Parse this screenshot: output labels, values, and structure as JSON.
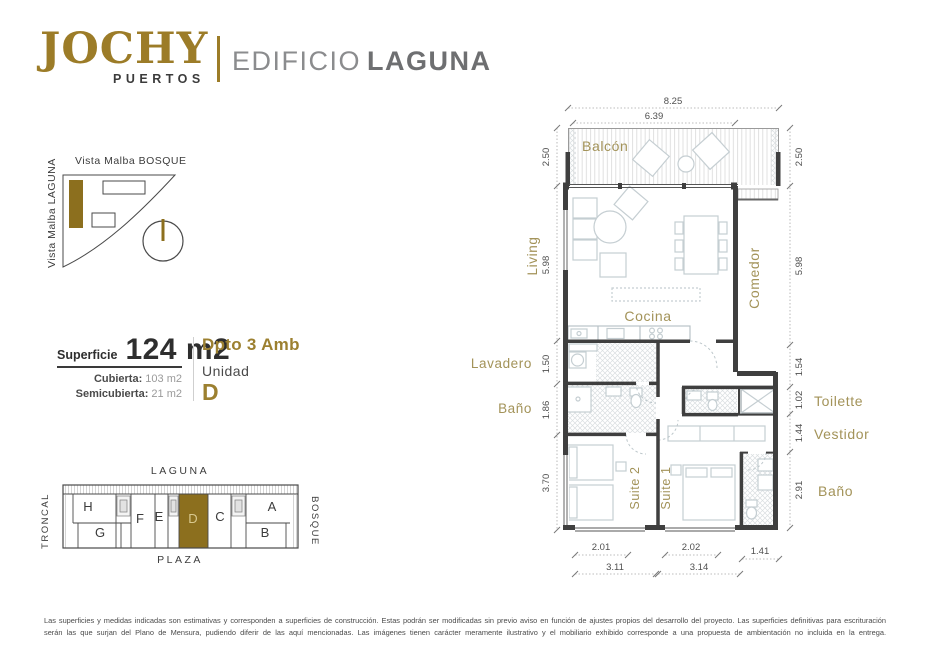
{
  "header": {
    "brand": "JOCHY",
    "brand_sub": "PUERTOS",
    "building_prefix": "EDIFICIO",
    "building_name": "LAGUNA"
  },
  "orientation": {
    "top_label": "Vista Malba BOSQUE",
    "side_label": "Vista Malba LAGUNA"
  },
  "summary": {
    "superficie_label": "Superficie",
    "superficie_value": "124 m2",
    "cubierta_label": "Cubierta:",
    "cubierta_value": "103 m2",
    "semicubierta_label": "Semicubierta:",
    "semicubierta_value": "21 m2",
    "dpto": "Dpto 3 Amb",
    "unidad_label": "Unidad",
    "unidad_value": "D"
  },
  "keyplan": {
    "labels": {
      "top": "LAGUNA",
      "bottom": "PLAZA",
      "left": "TRONCAL",
      "right": "BOSQUE"
    },
    "units_top": [
      "H",
      "F",
      "E",
      "D",
      "C",
      "A"
    ],
    "units_bottom": [
      "G",
      "B"
    ],
    "highlighted_unit": "D"
  },
  "floorplan": {
    "rooms": {
      "balcon": "Balcón",
      "living": "Living",
      "comedor": "Comedor",
      "cocina": "Cocina",
      "lavadero": "Lavadero",
      "bano_left": "Baño",
      "suite2": "Suite 2",
      "suite1": "Suite 1",
      "toilette": "Toilette",
      "vestidor": "Vestidor",
      "bano_right": "Baño"
    },
    "dims": {
      "top": [
        "8.25",
        "6.39"
      ],
      "left": [
        "2.50",
        "5.98",
        "1.50",
        "1.86",
        "3.70"
      ],
      "right": [
        "2.50",
        "5.98",
        "1.54",
        "1.02",
        "1.44",
        "2.91"
      ],
      "bottom_inner": [
        "2.01",
        "2.02",
        "1.41"
      ],
      "bottom_total": [
        "3.11",
        "3.14"
      ]
    }
  },
  "footer": {
    "line1": "Las superficies y medidas indicadas son estimativas y corresponden a superficies de construcción. Estas podrán ser modificadas sin previo aviso en función de ajustes propios del desarrollo del proyecto. Las superficies definitivas para escrituración",
    "line2": "serán las que surjan del Plano de Mensura, pudiendo diferir de las aquí mencionadas. Las imágenes tienen carácter meramente ilustrativo y el mobiliario exhibido corresponde a una propuesta de ambientación no incluida en la entrega."
  },
  "colors": {
    "brand_gold": "#9c7c28",
    "label_gold": "#a39359",
    "unit_fill_gold": "#8c6f1e",
    "wall": "#3f3f3f",
    "furniture": "#c5ced2"
  }
}
